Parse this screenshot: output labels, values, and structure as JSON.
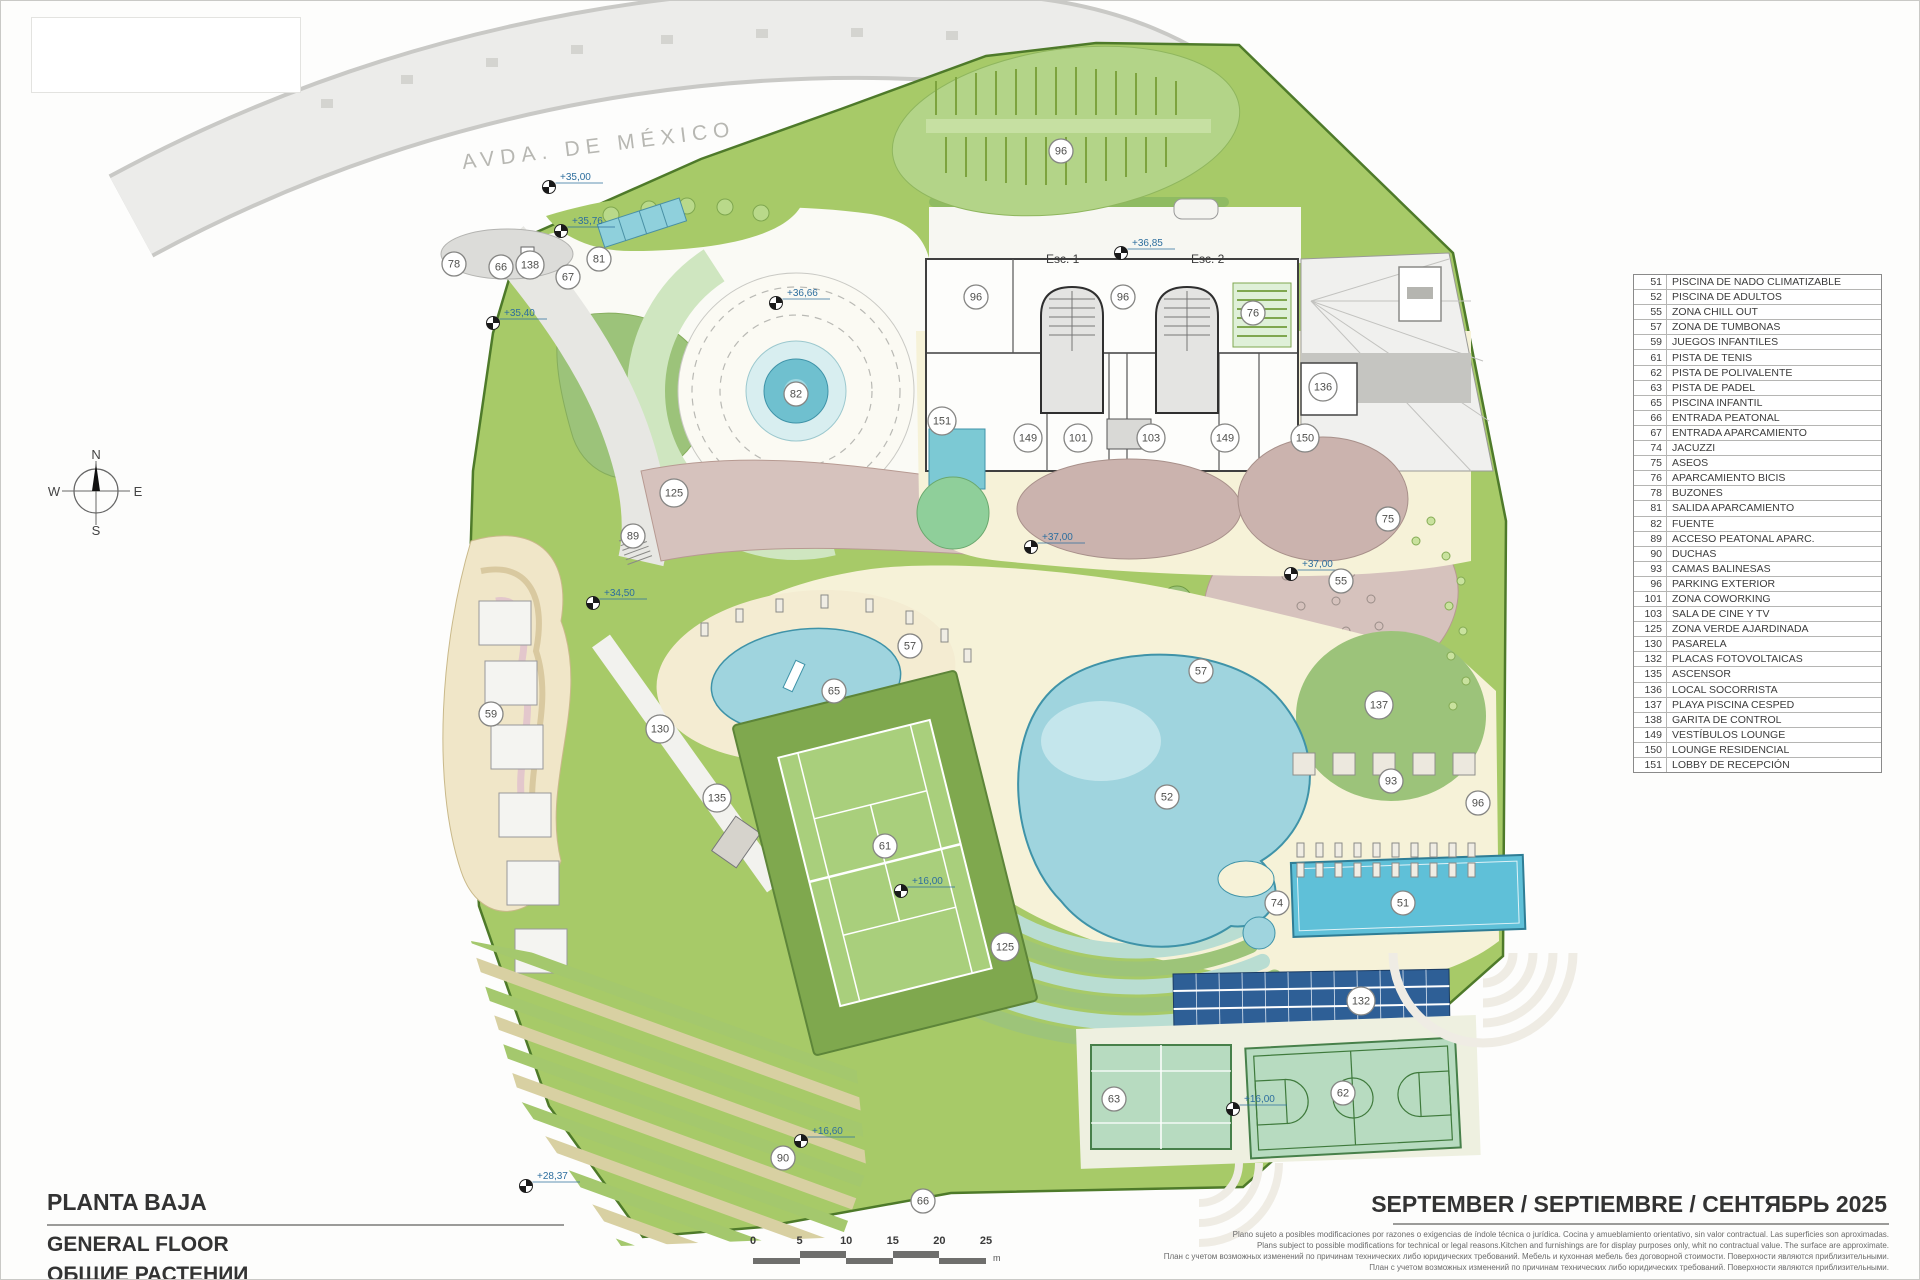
{
  "page": {
    "title_es": "PLANTA BAJA",
    "title_en": "GENERAL FLOOR",
    "title_ru": "ОБЩИЕ РАСТЕНИИ",
    "date_line": "SEPTEMBER / SEPTIEMBRE / СЕНТЯБРЬ 2025"
  },
  "street_label": "AVDA. DE MÉXICO",
  "building": {
    "stair1": "Esc. 1",
    "stair2": "Esc. 2"
  },
  "compass": {
    "north": "N",
    "south": "S",
    "east": "E",
    "west": "W"
  },
  "legend": {
    "items": [
      {
        "num": "51",
        "label": "PISCINA DE NADO CLIMATIZABLE"
      },
      {
        "num": "52",
        "label": "PISCINA DE ADULTOS"
      },
      {
        "num": "55",
        "label": "ZONA CHILL OUT"
      },
      {
        "num": "57",
        "label": "ZONA DE TUMBONAS"
      },
      {
        "num": "59",
        "label": "JUEGOS INFANTILES"
      },
      {
        "num": "61",
        "label": "PISTA DE TENIS"
      },
      {
        "num": "62",
        "label": "PISTA DE POLIVALENTE"
      },
      {
        "num": "63",
        "label": "PISTA DE PADEL"
      },
      {
        "num": "65",
        "label": "PISCINA INFANTIL"
      },
      {
        "num": "66",
        "label": "ENTRADA PEATONAL"
      },
      {
        "num": "67",
        "label": "ENTRADA APARCAMIENTO"
      },
      {
        "num": "74",
        "label": "JACUZZI"
      },
      {
        "num": "75",
        "label": "ASEOS"
      },
      {
        "num": "76",
        "label": "APARCAMIENTO BICIS"
      },
      {
        "num": "78",
        "label": "BUZONES"
      },
      {
        "num": "81",
        "label": "SALIDA APARCAMIENTO"
      },
      {
        "num": "82",
        "label": "FUENTE"
      },
      {
        "num": "89",
        "label": "ACCESO PEATONAL APARC."
      },
      {
        "num": "90",
        "label": "DUCHAS"
      },
      {
        "num": "93",
        "label": "CAMAS BALINESAS"
      },
      {
        "num": "96",
        "label": "PARKING EXTERIOR"
      },
      {
        "num": "101",
        "label": "ZONA COWORKING"
      },
      {
        "num": "103",
        "label": "SALA DE CINE Y TV"
      },
      {
        "num": "125",
        "label": "ZONA VERDE AJARDINADA"
      },
      {
        "num": "130",
        "label": "PASARELA"
      },
      {
        "num": "132",
        "label": "PLACAS FOTOVOLTAICAS"
      },
      {
        "num": "135",
        "label": "ASCENSOR"
      },
      {
        "num": "136",
        "label": "LOCAL SOCORRISTA"
      },
      {
        "num": "137",
        "label": "PLAYA PISCINA CESPED"
      },
      {
        "num": "138",
        "label": "GARITA DE CONTROL"
      },
      {
        "num": "149",
        "label": "VESTÍBULOS LOUNGE"
      },
      {
        "num": "150",
        "label": "LOUNGE RESIDENCIAL"
      },
      {
        "num": "151",
        "label": "LOBBY DE RECEPCIÓN"
      }
    ]
  },
  "plan": {
    "markers": [
      {
        "n": "78",
        "x": 453,
        "y": 263
      },
      {
        "n": "66",
        "x": 500,
        "y": 266
      },
      {
        "n": "138",
        "x": 529,
        "y": 264
      },
      {
        "n": "67",
        "x": 567,
        "y": 276
      },
      {
        "n": "81",
        "x": 598,
        "y": 258
      },
      {
        "n": "96",
        "x": 1060,
        "y": 150
      },
      {
        "n": "96",
        "x": 975,
        "y": 296
      },
      {
        "n": "96",
        "x": 1122,
        "y": 296
      },
      {
        "n": "76",
        "x": 1252,
        "y": 312
      },
      {
        "n": "136",
        "x": 1322,
        "y": 386
      },
      {
        "n": "82",
        "x": 795,
        "y": 393
      },
      {
        "n": "151",
        "x": 941,
        "y": 420
      },
      {
        "n": "149",
        "x": 1027,
        "y": 437
      },
      {
        "n": "101",
        "x": 1077,
        "y": 437
      },
      {
        "n": "103",
        "x": 1150,
        "y": 437
      },
      {
        "n": "149",
        "x": 1224,
        "y": 437
      },
      {
        "n": "150",
        "x": 1304,
        "y": 437
      },
      {
        "n": "125",
        "x": 673,
        "y": 492
      },
      {
        "n": "89",
        "x": 632,
        "y": 535
      },
      {
        "n": "75",
        "x": 1387,
        "y": 518
      },
      {
        "n": "55",
        "x": 1340,
        "y": 580
      },
      {
        "n": "57",
        "x": 909,
        "y": 645
      },
      {
        "n": "57",
        "x": 1200,
        "y": 670
      },
      {
        "n": "65",
        "x": 833,
        "y": 690
      },
      {
        "n": "59",
        "x": 490,
        "y": 713
      },
      {
        "n": "130",
        "x": 659,
        "y": 728
      },
      {
        "n": "135",
        "x": 716,
        "y": 797
      },
      {
        "n": "137",
        "x": 1378,
        "y": 704
      },
      {
        "n": "93",
        "x": 1390,
        "y": 780
      },
      {
        "n": "96",
        "x": 1477,
        "y": 802
      },
      {
        "n": "52",
        "x": 1166,
        "y": 796
      },
      {
        "n": "125",
        "x": 1004,
        "y": 946
      },
      {
        "n": "61",
        "x": 884,
        "y": 845
      },
      {
        "n": "74",
        "x": 1276,
        "y": 902
      },
      {
        "n": "51",
        "x": 1402,
        "y": 902
      },
      {
        "n": "132",
        "x": 1360,
        "y": 1000
      },
      {
        "n": "63",
        "x": 1113,
        "y": 1098
      },
      {
        "n": "62",
        "x": 1342,
        "y": 1092
      },
      {
        "n": "90",
        "x": 782,
        "y": 1157
      },
      {
        "n": "66",
        "x": 922,
        "y": 1200
      }
    ],
    "levels": [
      {
        "v": "+35,00",
        "x": 548,
        "y": 186
      },
      {
        "v": "+35,76",
        "x": 560,
        "y": 230
      },
      {
        "v": "+35,40",
        "x": 492,
        "y": 322
      },
      {
        "v": "+36,66",
        "x": 775,
        "y": 302
      },
      {
        "v": "+36,85",
        "x": 1120,
        "y": 252
      },
      {
        "v": "+37,00",
        "x": 1030,
        "y": 546
      },
      {
        "v": "+37,00",
        "x": 1290,
        "y": 573
      },
      {
        "v": "+34,50",
        "x": 592,
        "y": 602
      },
      {
        "v": "+16,00",
        "x": 900,
        "y": 890
      },
      {
        "v": "+16,00",
        "x": 1232,
        "y": 1108
      },
      {
        "v": "+16,60",
        "x": 800,
        "y": 1140
      },
      {
        "v": "+28,37",
        "x": 525,
        "y": 1185
      }
    ]
  },
  "scale_bar": {
    "labels": [
      "0",
      "5",
      "10",
      "15",
      "20",
      "25"
    ],
    "unit": "m"
  },
  "disclaimer": {
    "line1": "Plano sujeto a posibles modificaciones por razones o exigencias de índole técnica o jurídica. Cocina y amueblamiento orientativo, sin valor contractual. Las superficies son aproximadas.",
    "line2": "Plans subject to possible modifications for technical or legal reasons.Kitchen and furnishings are for display purposes only, whit no contractual value. The surface are approximate.",
    "line3": "План с учетом возможных изменений по причинам технических либо юридических требований. Мебель и кухонная мебель без договорной стоимости. Поверхности являются приблизительными.",
    "line4": "План с учетом возможных изменений по причинам технических либо юридических требований. Поверхности являются приблизительными."
  },
  "colors": {
    "lawn_green": "#a7ca68",
    "mint_green": "#9cc37a",
    "pool_blue": "#9fd4de",
    "lap_pool_blue": "#5fc0d8",
    "solar_blue": "#2e5f96",
    "terrace_mauve": "#d6c2bd",
    "deck_cream": "#f6f2d8",
    "road_gray": "#ececе9",
    "level_text_blue": "#2d6e9e"
  }
}
